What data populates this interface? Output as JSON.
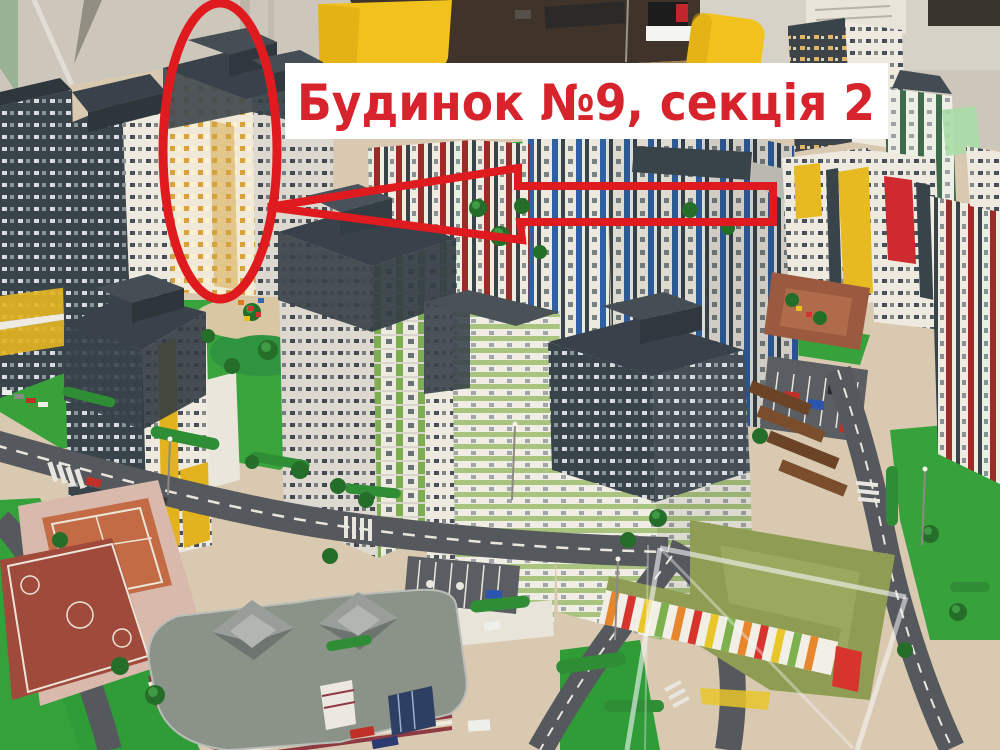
{
  "annotation": {
    "label": "Будинок №9, секція 2",
    "text_color": "#d7232c",
    "shape_color": "#e01b1f",
    "banner_bg": "#ffffff"
  },
  "palette": {
    "wall": "#cdc6ba",
    "table_wood": "#40332a",
    "desk_tan": "#c8a36e",
    "chair_yellow": "#f1c11d",
    "facade_light": "#eeeae0",
    "facade_dark": "#39434a",
    "accent_gold": "#d9a33c",
    "accent_yellow": "#e3b422",
    "accent_green": "#7fae52",
    "accent_blue": "#30609f",
    "accent_red": "#9c2b28",
    "lawn": "#3aa43c",
    "road": "#55585c",
    "court_clay": "#c26b44",
    "court_red": "#a04a3c",
    "school_roof": "#8b9287",
    "kindergarten_roof": "#8e9d53",
    "path_tan": "#d9c9b1"
  }
}
